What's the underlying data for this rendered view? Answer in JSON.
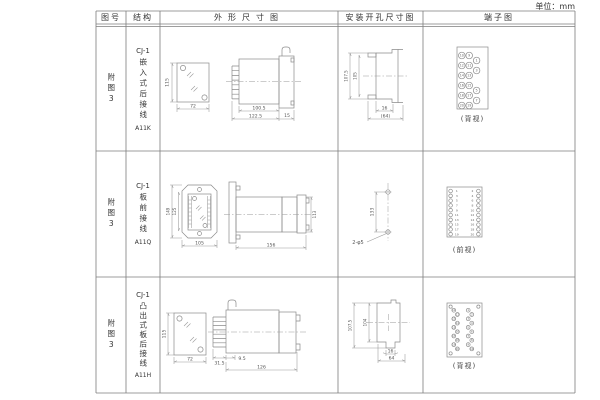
{
  "unit_label": "单位：mm",
  "headers": {
    "fig_no": "图号",
    "structure": "结构",
    "outline": "外形尺寸图",
    "mounting": "安装开孔尺寸图",
    "terminal": "端子图"
  },
  "rows": [
    {
      "fig_no": "附图3",
      "series": "CJ-1",
      "structure_text": "嵌入式后接线",
      "model": "A11K",
      "outline_dims": {
        "front_height": "115",
        "front_width": "72",
        "body_length": "100.5",
        "total_length": "122.5",
        "flange_width": "15"
      },
      "mounting_dims": {
        "outer_height": "107.5",
        "inner_height": "105",
        "notch_width": "16",
        "cutout_width": "(64)"
      },
      "terminal": {
        "caption": "(背视)",
        "left_pairs": [
          [
            "10",
            "9"
          ],
          [
            "12",
            "11"
          ],
          [
            "14",
            "13"
          ],
          [
            "16",
            "15"
          ],
          [
            "18",
            "17"
          ],
          [
            "20",
            "19"
          ]
        ],
        "right_column": [
          "1",
          "3",
          "5",
          "7"
        ]
      }
    },
    {
      "fig_no": "附图3",
      "series": "CJ-1",
      "structure_text": "板前接线",
      "model": "A11Q",
      "outline_dims": {
        "outer_height": "149",
        "inner_height": "125",
        "front_width": "105",
        "side_length": "156",
        "side_height": "113"
      },
      "mounting_dims": {
        "hole_spacing": "133",
        "hole_spec": "2-φ5"
      },
      "terminal": {
        "caption": "(前视)",
        "left_column": [
          "1",
          "3",
          "5",
          "7",
          "9",
          "11",
          "13",
          "15",
          "17",
          "19"
        ],
        "right_column": [
          "2",
          "4",
          "6",
          "8",
          "10",
          "12",
          "14",
          "16",
          "18",
          "20"
        ]
      }
    },
    {
      "fig_no": "附图3",
      "series": "CJ-1",
      "structure_text": "凸出式板后接线",
      "model": "A11H",
      "outline_dims": {
        "front_height": "115",
        "front_width": "72",
        "rear_depth": "31.5",
        "step": "9.5",
        "body_length": "126"
      },
      "mounting_dims": {
        "outer_height": "107.5",
        "inner_height": "104",
        "notch_width": "16",
        "cutout_width": "64"
      },
      "terminal": {
        "caption": "(背视)",
        "left_column": [
          "11",
          "12",
          "13",
          "14",
          "15",
          "16",
          "17",
          "18",
          "19",
          "20"
        ],
        "right_column": [
          "1",
          "2",
          "3",
          "4",
          "5",
          "6",
          "7",
          "8",
          "9",
          "10"
        ]
      }
    }
  ]
}
